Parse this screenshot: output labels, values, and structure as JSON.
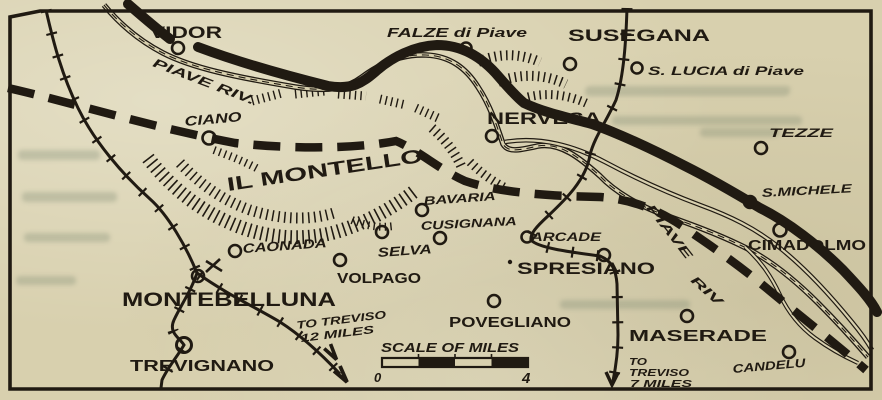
{
  "map_region": "IL MONTELLO",
  "colors": {
    "paper": "#d8d0ae",
    "ink": "#201a12"
  },
  "labels": {
    "vidor": "VIDOR",
    "falze": "FALZE di Piave",
    "susegana": "SUSEGANA",
    "s_lucia": "S. LUCIA di Piave",
    "tezze": "TEZZE",
    "nervesa": "NERVESA",
    "ciano": "CIANO",
    "montello": "IL MONTELLO",
    "bavaria": "BAVARIA",
    "cusignana": "CUSIGNANA",
    "selva": "SELVA",
    "caonada": "CAONADA",
    "arcade": "ARCADE",
    "s_michele": "S.MICHELE",
    "cimadolmo": "CIMADOLMO",
    "volpago": "VOLPAGO",
    "spresiano": "SPRESIANO",
    "montebelluna": "MONTEBELLUNA",
    "povegliano": "POVEGLIANO",
    "maserade": "MASERADE",
    "candelu": "CANDELU",
    "trevignano": "TREVIGNANO"
  },
  "river": {
    "piave_nw": "PIAVE RIV.",
    "piave_se_word1": "PIAVE",
    "piave_se_word2": "RIV"
  },
  "routes": {
    "to_treviso_12_line1": "TO TREVISO",
    "to_treviso_12_line2": "12 MILES",
    "to_treviso_7_line1": "TO",
    "to_treviso_7_line2": "TREVISO",
    "to_treviso_7_line3": "7 MILES"
  },
  "scale": {
    "title": "SCALE OF MILES",
    "start": "0",
    "end": "4"
  }
}
